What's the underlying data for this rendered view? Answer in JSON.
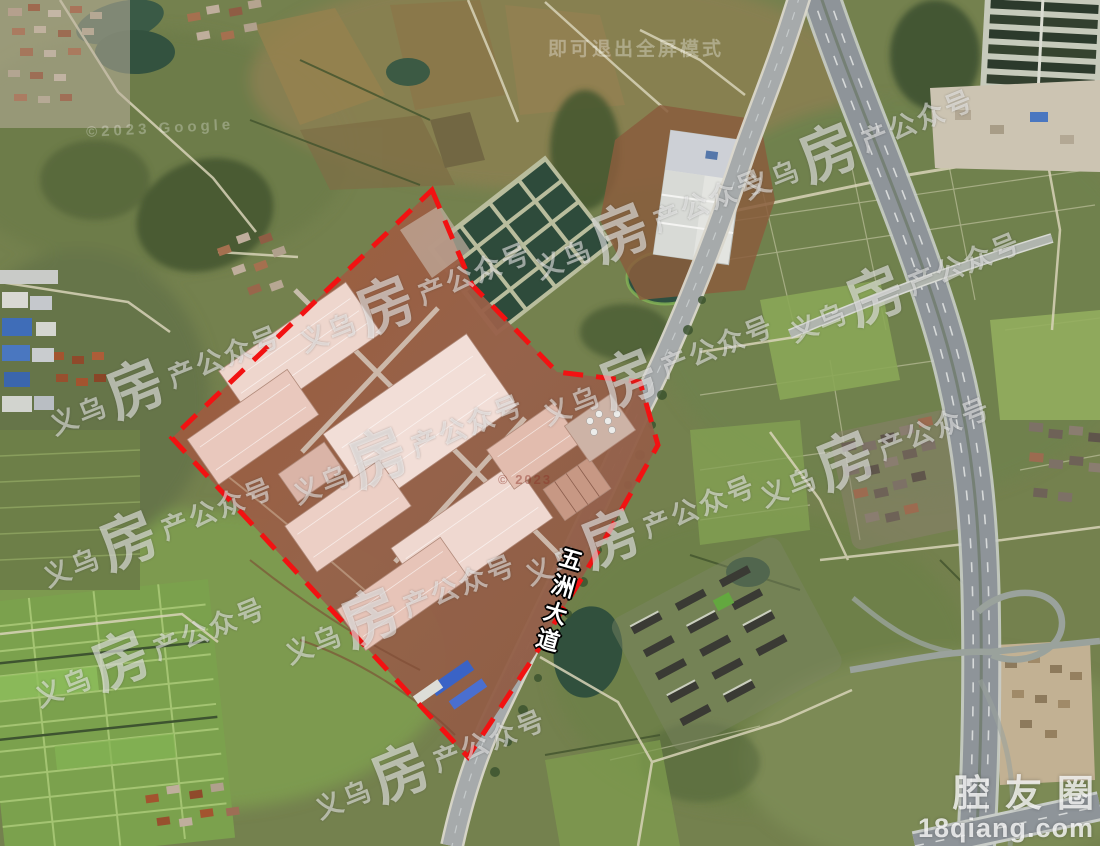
{
  "window": {
    "width": 1100,
    "height": 846,
    "view": "satellite-imagery"
  },
  "map": {
    "road_label": "五洲大道",
    "parcel_outline": {
      "style": "dashed",
      "color": "#f21212"
    }
  },
  "watermarks": {
    "tiled": {
      "prefix": "义乌",
      "logo": "房",
      "suffix": "产公众号",
      "color": "#ffffff",
      "instances": [
        {
          "x": 165,
          "y": 378
        },
        {
          "x": 415,
          "y": 295
        },
        {
          "x": 650,
          "y": 222
        },
        {
          "x": 858,
          "y": 142
        },
        {
          "x": 905,
          "y": 285
        },
        {
          "x": 408,
          "y": 447
        },
        {
          "x": 658,
          "y": 368
        },
        {
          "x": 158,
          "y": 530
        },
        {
          "x": 640,
          "y": 528
        },
        {
          "x": 875,
          "y": 450
        },
        {
          "x": 400,
          "y": 607
        },
        {
          "x": 150,
          "y": 650
        },
        {
          "x": 430,
          "y": 762
        }
      ]
    },
    "corner": {
      "line1": "腔友圈",
      "line2": "18qiang.com"
    },
    "fullscreen_hint": "即可退出全屏模式",
    "copyright_top_left": "©2023 Google",
    "copyright_center": "© 2023"
  },
  "colors": {
    "boundary_red": "#f21212",
    "factory_roof_pink": "#eed6cd",
    "bare_earth_brown": "#9a6040",
    "road_gray": "#a6aaab",
    "highway_gray": "#8e9499",
    "pond_dark_green": "#31503d",
    "paddy_green": "#7ba14d",
    "blue_roof": "#3a63c6",
    "base_farmland": "#74814e"
  }
}
